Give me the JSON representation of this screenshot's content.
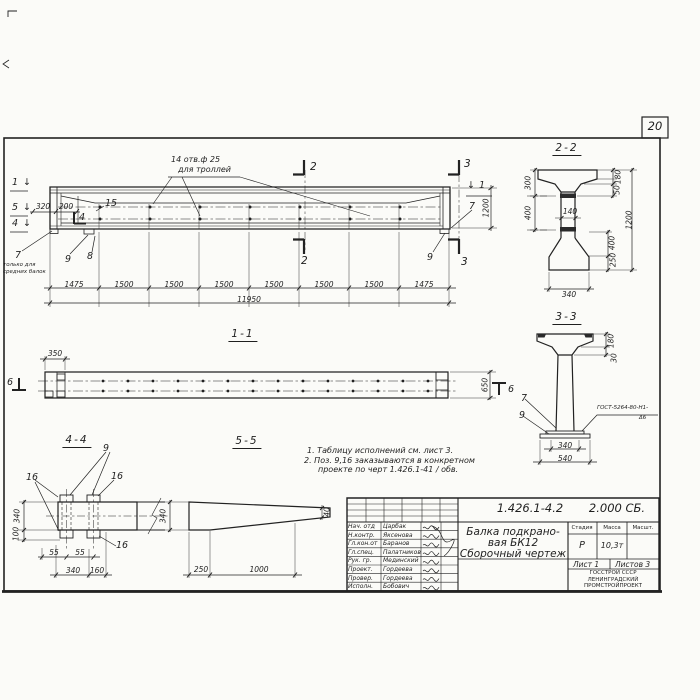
{
  "sheet": {
    "number": "20"
  },
  "glyphs": {
    "down_arrow": "↓"
  },
  "main_view": {
    "callout": {
      "line1": "14 отв.ф 25",
      "line2": "для троллей"
    },
    "marks": {
      "left1": "1",
      "left5": "5",
      "left4": "4",
      "inner4": "4",
      "top2": "2",
      "bottom2": "2",
      "top3": "3",
      "bottom3": "3",
      "right1": "1"
    },
    "pos": {
      "p15": "15",
      "p7_left": "7",
      "p8": "8",
      "p9_left": "9",
      "p9_right": "9",
      "p7_right": "7"
    },
    "note": {
      "line1": "только для",
      "line2": "средних балок"
    },
    "dims": {
      "d320": "320",
      "d200": "200",
      "height": "1200",
      "total": "11950",
      "segments": [
        "1475",
        "1500",
        "1500",
        "1500",
        "1500",
        "1500",
        "1500",
        "1475"
      ]
    }
  },
  "section22": {
    "title": "2-2",
    "dims": {
      "left300": "300",
      "left400": "400",
      "web140": "140",
      "right180": "180",
      "right50": "50",
      "right400": "400",
      "right250": "250",
      "height1200": "1200",
      "bottom340": "340"
    }
  },
  "section33": {
    "title": "3-3",
    "pos": {
      "p7": "7",
      "p9": "9"
    },
    "weld": {
      "line1": "ГОСТ-5264-80-Н1-",
      "line2": "Δ6"
    },
    "dims": {
      "right180": "180",
      "right30": "30",
      "bottom340": "340",
      "bottom540": "540"
    }
  },
  "view11": {
    "title": "1-1",
    "marks": {
      "left6": "6",
      "right6": "6"
    },
    "dims": {
      "d350": "350",
      "d650": "650"
    }
  },
  "view44": {
    "title": "4-4",
    "pos": {
      "p9": "9",
      "p16_left": "16",
      "p16_right": "16",
      "p16_bottom": "16"
    },
    "dims": {
      "v340": "340",
      "v100": "100",
      "d55a": "55",
      "d55b": "55",
      "d340": "340",
      "d160": "160"
    }
  },
  "view55": {
    "title": "5-5",
    "dims": {
      "v340": "340",
      "d250": "250",
      "d1000": "1000",
      "tip40": "40"
    }
  },
  "notes": {
    "line1": "1. Таблицу исполнений  см. лист 3.",
    "line2": "2. Поз. 9,16 заказываются в конкретном",
    "line3": "проекте по черт 1.426.1-41 / обв."
  },
  "title_block": {
    "doc_number": "1.426.1-4.2",
    "doc_code": "2.000 СБ.",
    "title_line1": "Балка подкрано-",
    "title_line2": "вая БК12",
    "title_line3": "Сборочный чертеж",
    "stage_header": "Стадия",
    "mass_header": "Масса",
    "scale_header": "Масшт.",
    "stage": "Р",
    "mass": "10,3т",
    "sheet_label": "Лист 1",
    "sheets_label": "Листов 3",
    "org_line1": "ГОССТРОЙ СССР",
    "org_line2": "ЛЕНИНГРАДСКИЙ",
    "org_line3": "ПРОМСТРОЙПРОЕКТ",
    "rows": [
      {
        "role": "Нач. отд",
        "name": "Царбак"
      },
      {
        "role": "Н.контр.",
        "name": "Яксенова"
      },
      {
        "role": "Гл.кон.от",
        "name": "Баранов"
      },
      {
        "role": "Гл.спец.",
        "name": "Палатников"
      },
      {
        "role": "Рук. гр.",
        "name": "Мединский"
      },
      {
        "role": "Проект.",
        "name": "Гордеева"
      },
      {
        "role": "Провер.",
        "name": "Гордеева"
      },
      {
        "role": "Исполн.",
        "name": "Бобович"
      }
    ]
  }
}
